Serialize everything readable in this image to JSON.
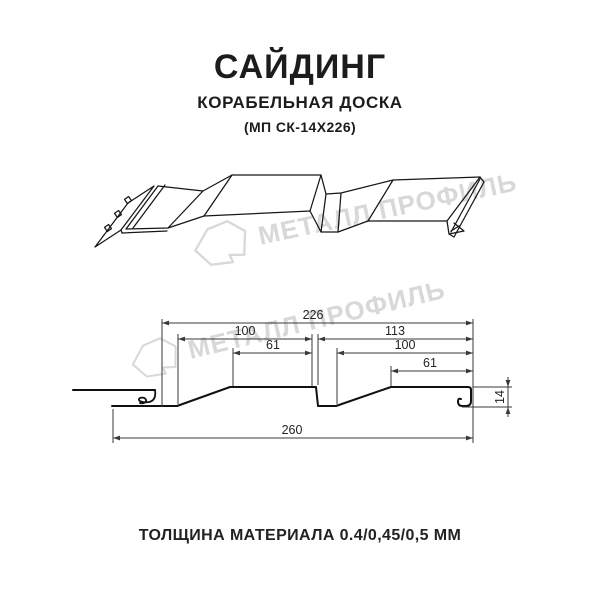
{
  "title": {
    "main": "САЙДИНГ",
    "subtitle": "КОРАБЕЛЬНАЯ ДОСКА",
    "model": "(МП СК-14Х226)"
  },
  "watermark": {
    "text": "МЕТАЛЛ ПРОФИЛЬ",
    "color": "#d8d8d8"
  },
  "dimensions": {
    "profile_width": "226",
    "left_pitch": "100",
    "left_flat": "61",
    "right_pitch": "113",
    "right_inner": "100",
    "right_flat": "61",
    "overall_width": "260",
    "height": "14"
  },
  "footer": {
    "thickness_label": "ТОЛЩИНА МАТЕРИАЛА 0.4/0,45/0,5 ММ"
  },
  "colors": {
    "line": "#111111",
    "dimension": "#3a3a3a",
    "watermark": "#d8d8d8"
  }
}
